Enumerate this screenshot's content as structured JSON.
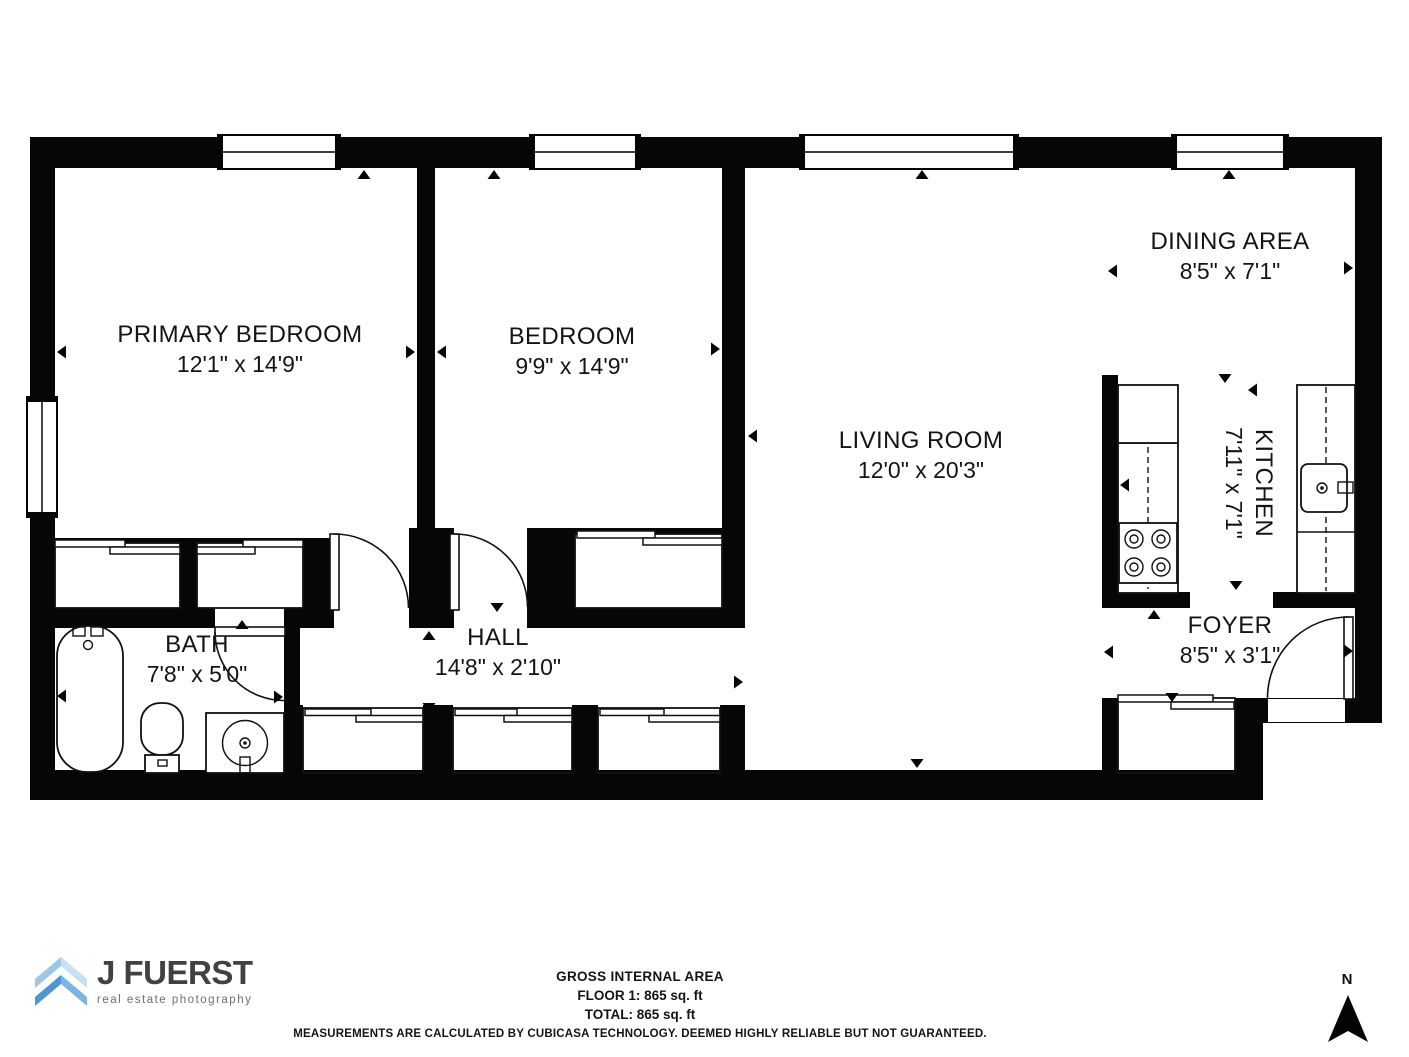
{
  "rooms": [
    {
      "name": "PRIMARY BEDROOM",
      "dims": "12'1\" x 14'9\""
    },
    {
      "name": "BEDROOM",
      "dims": "9'9\" x 14'9\""
    },
    {
      "name": "LIVING ROOM",
      "dims": "12'0\" x 20'3\""
    },
    {
      "name": "DINING AREA",
      "dims": "8'5\" x 7'1\""
    },
    {
      "name": "KITCHEN",
      "dims": "7'11\" x 7'1\""
    },
    {
      "name": "BATH",
      "dims": "7'8\" x 5'0\""
    },
    {
      "name": "HALL",
      "dims": "14'8\" x 2'10\""
    },
    {
      "name": "FOYER",
      "dims": "8'5\" x 3'1\""
    }
  ],
  "footer": {
    "area_title": "GROSS INTERNAL AREA",
    "floor_line": "FLOOR 1: 865 sq. ft",
    "total_line": "TOTAL: 865 sq. ft",
    "disclaimer": "MEASUREMENTS ARE CALCULATED BY CUBICASA TECHNOLOGY. DEEMED HIGHLY RELIABLE BUT NOT GUARANTEED."
  },
  "logo": {
    "brand": "J FUERST",
    "tagline": "real estate photography",
    "text_color": "#414042",
    "tagline_color": "#6d6e71",
    "chevron_top_left": "#9cc6e7",
    "chevron_top_right": "#c9e0f3",
    "chevron_bottom_left": "#4f97cf",
    "chevron_bottom_right": "#7cb5e3"
  },
  "compass": {
    "label": "N"
  },
  "colors": {
    "wall": "#060606",
    "background": "#ffffff",
    "line": "#1a1a1a"
  }
}
